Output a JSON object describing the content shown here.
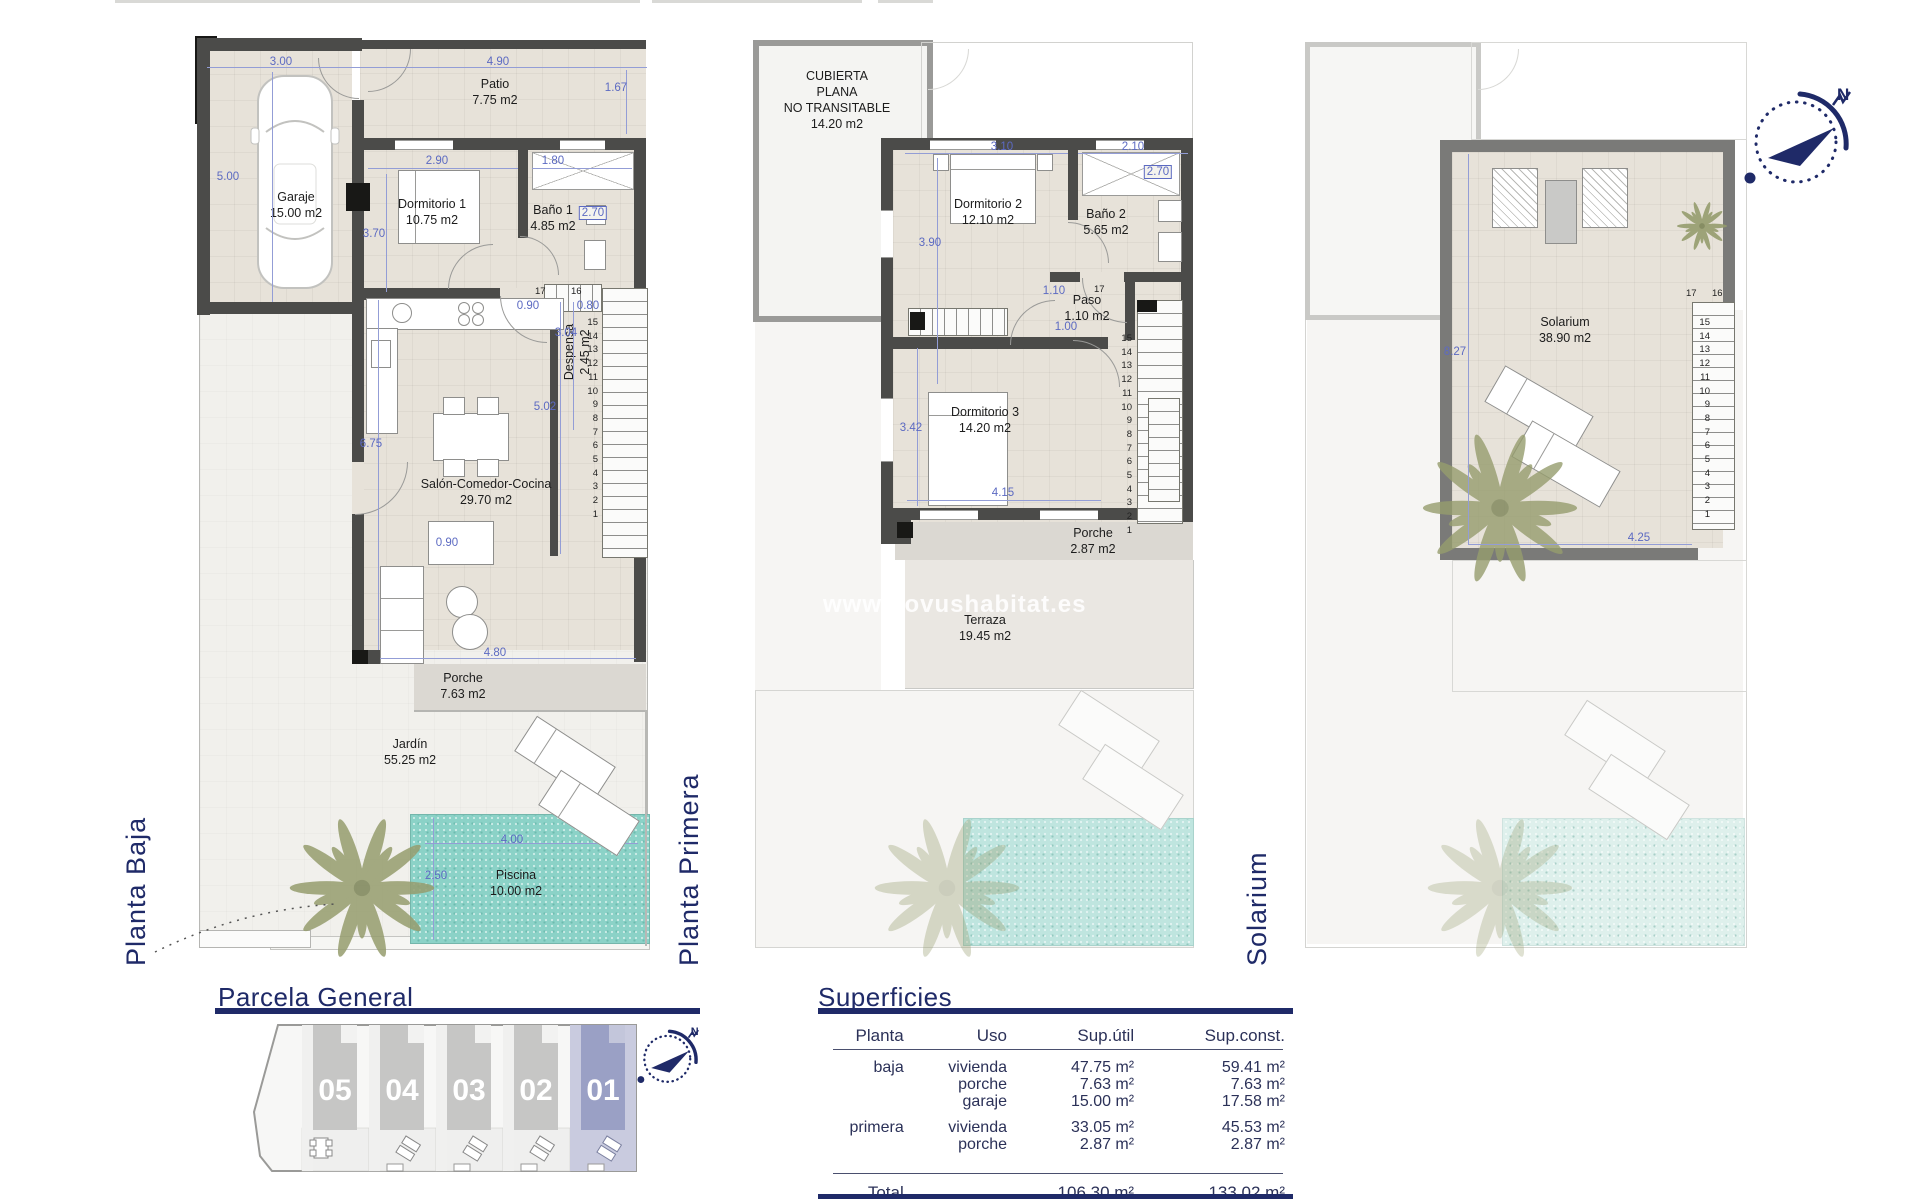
{
  "watermark": "www.novushabitat.es",
  "compass": {
    "north": "N"
  },
  "plan_baja": {
    "label": "Planta Baja",
    "garaje": {
      "name": "Garaje",
      "area": "15.00 m2"
    },
    "patio": {
      "name": "Patio",
      "area": "7.75 m2"
    },
    "dormitorio1": {
      "name": "Dormitorio 1",
      "area": "10.75 m2"
    },
    "bano1": {
      "name": "Baño 1",
      "area": "4.85 m2"
    },
    "despensa": {
      "name": "Despensa",
      "area": "2.45 m2"
    },
    "salon": {
      "name": "Salón-Comedor-Cocina",
      "area": "29.70 m2"
    },
    "porche": {
      "name": "Porche",
      "area": "7.63 m2"
    },
    "jardin": {
      "name": "Jardín",
      "area": "55.25 m2"
    },
    "piscina": {
      "name": "Piscina",
      "area": "10.00 m2"
    },
    "dims": {
      "d300": "3.00",
      "d490": "4.90",
      "d500": "5.00",
      "d167": "1.67",
      "d290": "2.90",
      "d180": "1.80",
      "d270": "2.70",
      "d370": "3.70",
      "d090a": "0.90",
      "d080": "0.80",
      "d304": "3.04",
      "d502": "5.02",
      "d675": "6.75",
      "d090b": "0.90",
      "d480": "4.80",
      "d400": "4.00",
      "d250": "2.50"
    },
    "stairs_top": [
      "17",
      "16"
    ],
    "stairs": [
      "15",
      "14",
      "13",
      "12",
      "11",
      "10",
      "9",
      "8",
      "7",
      "6",
      "5",
      "4",
      "3",
      "2",
      "1"
    ]
  },
  "plan_primera": {
    "label": "Planta Primera",
    "cubierta": {
      "line1": "CUBIERTA",
      "line2": "PLANA",
      "line3": "NO TRANSITABLE",
      "area": "14.20 m2"
    },
    "dormitorio2": {
      "name": "Dormitorio 2",
      "area": "12.10 m2"
    },
    "bano2": {
      "name": "Baño 2",
      "area": "5.65 m2"
    },
    "paso": {
      "name": "Paso",
      "area": "1.10 m2"
    },
    "dormitorio3": {
      "name": "Dormitorio 3",
      "area": "14.20 m2"
    },
    "porche": {
      "name": "Porche",
      "area": "2.87 m2"
    },
    "terraza": {
      "name": "Terraza",
      "area": "19.45 m2"
    },
    "dims": {
      "d310": "3.10",
      "d210": "2.10",
      "d390": "3.90",
      "d270": "2.70",
      "d110": "1.10",
      "d100": "1.00",
      "d17": "17",
      "d342": "3.42",
      "d415": "4.15"
    },
    "stairs": [
      "15",
      "14",
      "13",
      "12",
      "11",
      "10",
      "9",
      "8",
      "7",
      "6",
      "5",
      "4",
      "3",
      "2",
      "1"
    ]
  },
  "plan_solarium": {
    "label": "Solarium",
    "solarium": {
      "name": "Solarium",
      "area": "38.90 m2"
    },
    "dims": {
      "d827": "8.27",
      "d425": "4.25"
    },
    "stairs_top": [
      "17",
      "16"
    ],
    "stairs": [
      "15",
      "14",
      "13",
      "12",
      "11",
      "10",
      "9",
      "8",
      "7",
      "6",
      "5",
      "4",
      "3",
      "2",
      "1"
    ]
  },
  "parcela": {
    "title": "Parcela General",
    "units": [
      "05",
      "04",
      "03",
      "02",
      "01"
    ]
  },
  "superficies": {
    "title": "Superficies",
    "headers": {
      "planta": "Planta",
      "uso": "Uso",
      "util": "Sup.útil",
      "const": "Sup.const."
    },
    "rows": [
      {
        "planta": "baja",
        "uso": "vivienda",
        "util": "47.75 m²",
        "const": "59.41 m²"
      },
      {
        "planta": "",
        "uso": "porche",
        "util": "7.63 m²",
        "const": "7.63 m²"
      },
      {
        "planta": "",
        "uso": "garaje",
        "util": "15.00 m²",
        "const": "17.58 m²"
      },
      {
        "planta": "primera",
        "uso": "vivienda",
        "util": "33.05 m²",
        "const": "45.53 m²"
      },
      {
        "planta": "",
        "uso": "porche",
        "util": "2.87 m²",
        "const": "2.87 m²"
      }
    ],
    "total": {
      "label": "Total",
      "util": "106.30 m²",
      "const": "133.02 m²"
    }
  }
}
